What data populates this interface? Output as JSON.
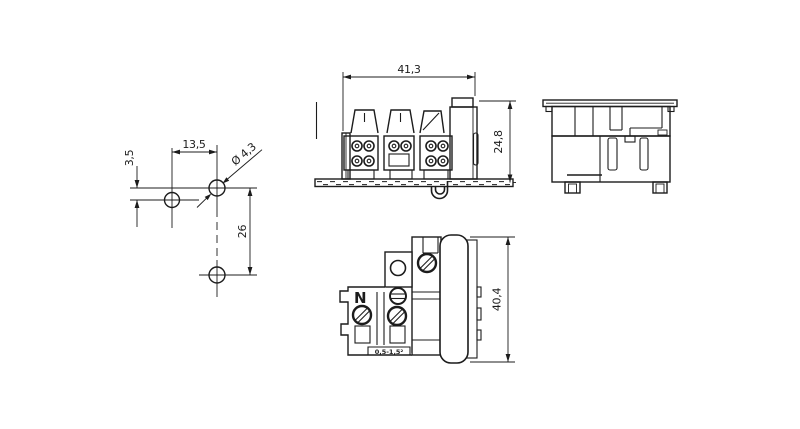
{
  "page": {
    "background": "#ffffff",
    "line_color": "#1c1c1c",
    "description": "Technical dimensional drawing of a 3-pole terminal block / connector with mounting hole pattern, front view on rail, side view and top view"
  },
  "views": {
    "hole_pattern": {
      "name": "mounting-hole-pattern",
      "dims": {
        "horizontal_spacing": "13,5",
        "vertical_offset": "3,5",
        "vertical_spacing": "26",
        "hole_diameter": "Ø 4,3"
      }
    },
    "front_view": {
      "name": "front-view-on-rail",
      "dims": {
        "width": "41,3",
        "height": "24,8"
      }
    },
    "side_view": {
      "name": "side-view"
    },
    "top_view": {
      "name": "top-view",
      "dims": {
        "height": "40,4"
      },
      "labels": {
        "neutral": "N",
        "wire_range": "0,5-1,5²"
      }
    }
  }
}
